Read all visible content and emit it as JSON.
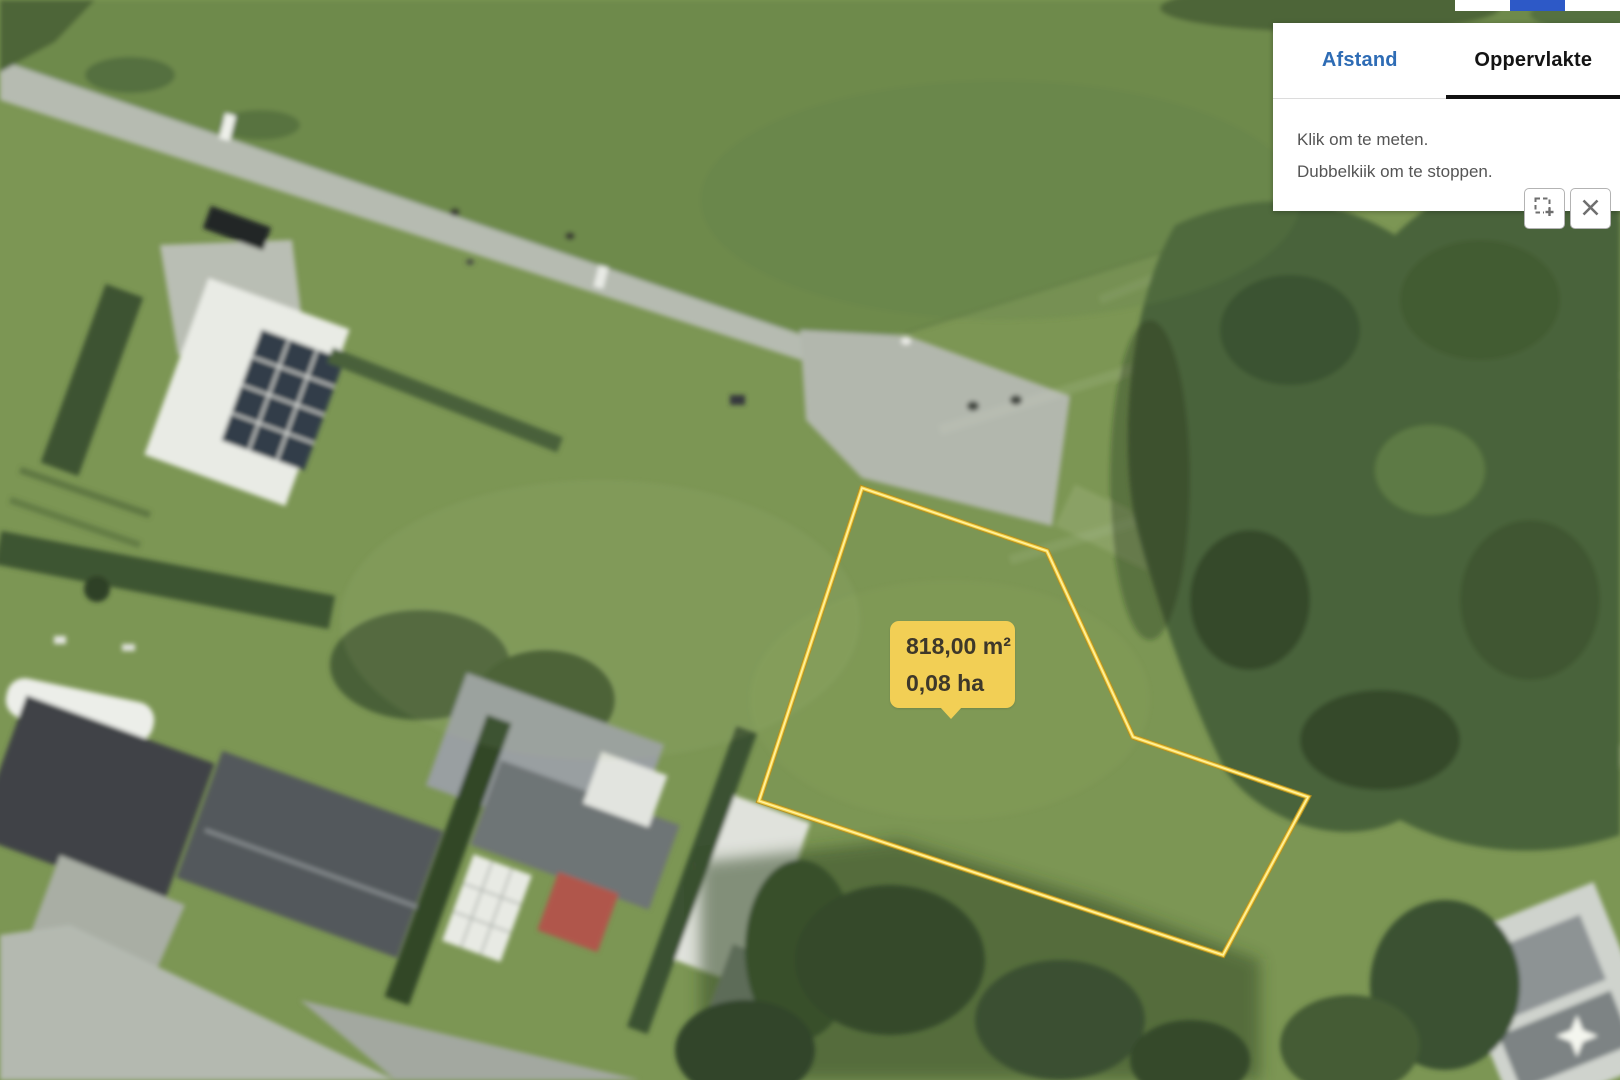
{
  "measure_panel": {
    "tabs": [
      {
        "label": "Afstand",
        "active": false
      },
      {
        "label": "Oppervlakte",
        "active": true
      }
    ],
    "instruction_line1": "Klik om te meten.",
    "instruction_line2": "Dubbelkiik om te stoppen.",
    "buttons": [
      {
        "name": "new-measurement"
      },
      {
        "name": "close"
      }
    ]
  },
  "measurement_label": {
    "area_m2": "818,00 m²",
    "area_ha": "0,08 ha"
  },
  "colors": {
    "label_yellow": "#f2cf55",
    "polygon_stroke_gold": "#c79a1e",
    "polygon_stroke_light": "#ffe97d",
    "tab_active_text": "#141414",
    "tab_inactive_blue": "#2e6cb5",
    "toolbar_blue": "#2d59c7",
    "instruction_gray": "#555555"
  }
}
